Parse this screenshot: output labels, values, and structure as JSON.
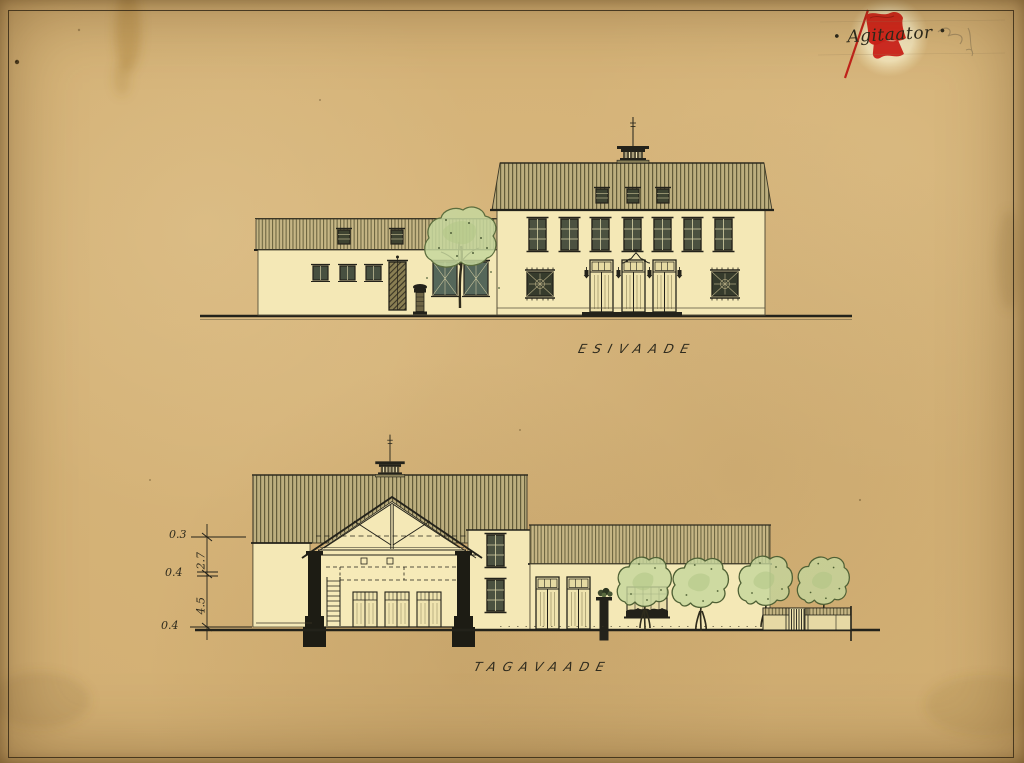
{
  "sheet": {
    "signature": {
      "dot_left": "•",
      "text": "Agitaator",
      "dot_right": "•"
    },
    "drawings": [
      {
        "id": "front-elevation",
        "label": "ESIVAADE"
      },
      {
        "id": "rear-elevation",
        "label": "TAGAVAADE"
      }
    ],
    "dimensions": [
      "0.3",
      "2.7",
      "0.4",
      "4.5",
      "0.4"
    ],
    "colors": {
      "paper": "#d3b074",
      "wall_cream": "#f4e8b6",
      "roof_khaki": "#b9ab7d",
      "ink": "#23221a",
      "foliage_green": "#c4d69c",
      "flag_red": "#d5251c"
    }
  }
}
